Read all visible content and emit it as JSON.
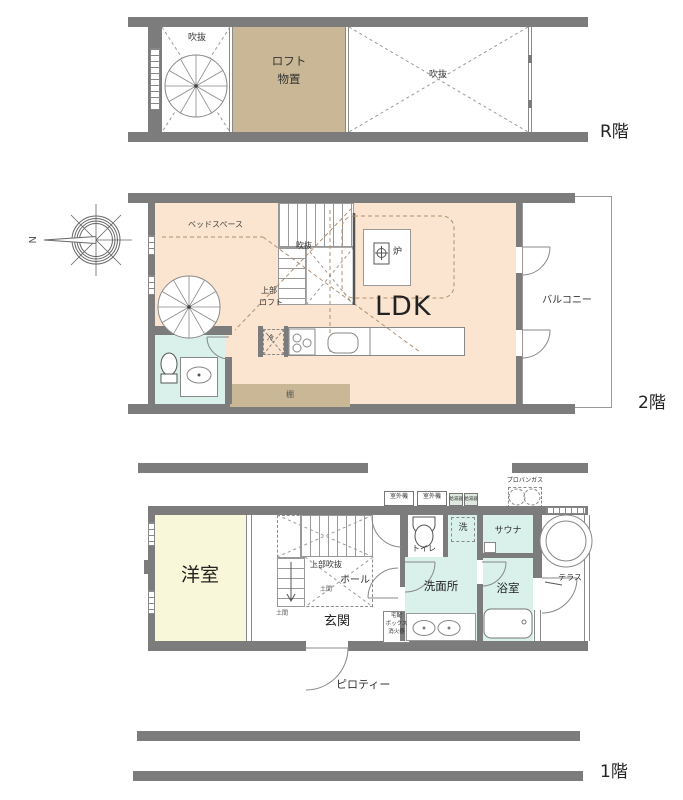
{
  "colors": {
    "wall": "#7c7c7c",
    "loft_fill": "#c9b795",
    "ldk_fill": "#fbe5d0",
    "wet_fill": "#d9f1ea",
    "room_fill": "#f8f7d9"
  },
  "floors": {
    "roof": {
      "floor_label": "R階",
      "void_left": "吹抜",
      "loft_line1": "ロフト",
      "loft_line2": "物置",
      "void_right": "吹抜"
    },
    "second": {
      "floor_label": "2階",
      "compass_north": "N",
      "bed_space": "ベッドスペース",
      "stair_void": "吹抜",
      "hearth": "炉",
      "ldk": "LDK",
      "upper_loft_line1": "上部",
      "upper_loft_line2": "ロフト",
      "fridge": "冷",
      "shelf": "棚",
      "balcony": "バルコニー"
    },
    "first": {
      "floor_label": "1階",
      "outdoor_unit_1": "室外機",
      "outdoor_unit_2": "室外機",
      "water_heater_1": "給湯器",
      "water_heater_2": "給湯器",
      "propane_gas": "プロパンガス",
      "western_room": "洋室",
      "upper_void": "上部吹抜",
      "hall": "ホール",
      "doma_1": "土間",
      "doma_2": "土間",
      "entrance": "玄関",
      "delivery_line1": "宅配",
      "delivery_line2": "ボックス",
      "delivery_line3": "消火器",
      "toilet": "トイレ",
      "laundry": "洗",
      "washroom": "洗面所",
      "sauna": "サウナ",
      "bathroom": "浴室",
      "terrace": "テラス",
      "pilotis": "ピロティー"
    }
  }
}
